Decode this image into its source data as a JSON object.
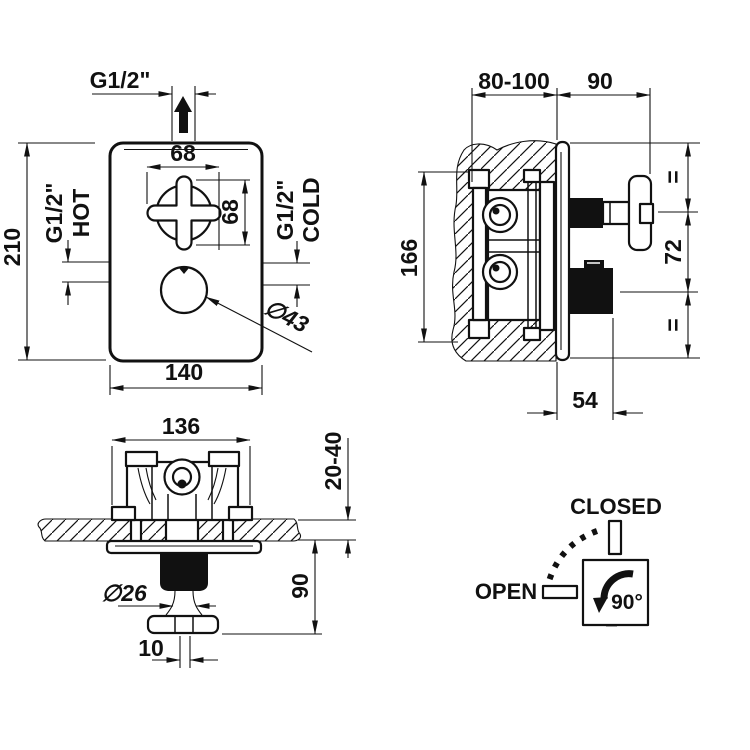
{
  "drawing": {
    "front_view": {
      "outlet_thread": "G1/2\"",
      "handle_width": "68",
      "handle_height": "68",
      "hot_thread": "G1/2\"",
      "hot_label": "HOT",
      "cold_thread": "G1/2\"",
      "cold_label": "COLD",
      "plate_height": "210",
      "plate_width": "140",
      "knob_diameter": "∅43"
    },
    "side_view": {
      "wall_depth_range": "80-100",
      "protrusion": "90",
      "body_height": "166",
      "equal_top": "=",
      "handle_spacing": "72",
      "equal_bottom": "=",
      "knob_offset": "54"
    },
    "top_view": {
      "body_width": "136",
      "wall_thickness_range": "20-40",
      "protrusion": "90",
      "stem_diameter": "∅26",
      "stem_width": "10"
    },
    "rotation_diagram": {
      "closed_label": "CLOSED",
      "open_label": "OPEN",
      "angle_label": "90°"
    }
  },
  "colors": {
    "line": "#111111",
    "background": "#ffffff"
  }
}
